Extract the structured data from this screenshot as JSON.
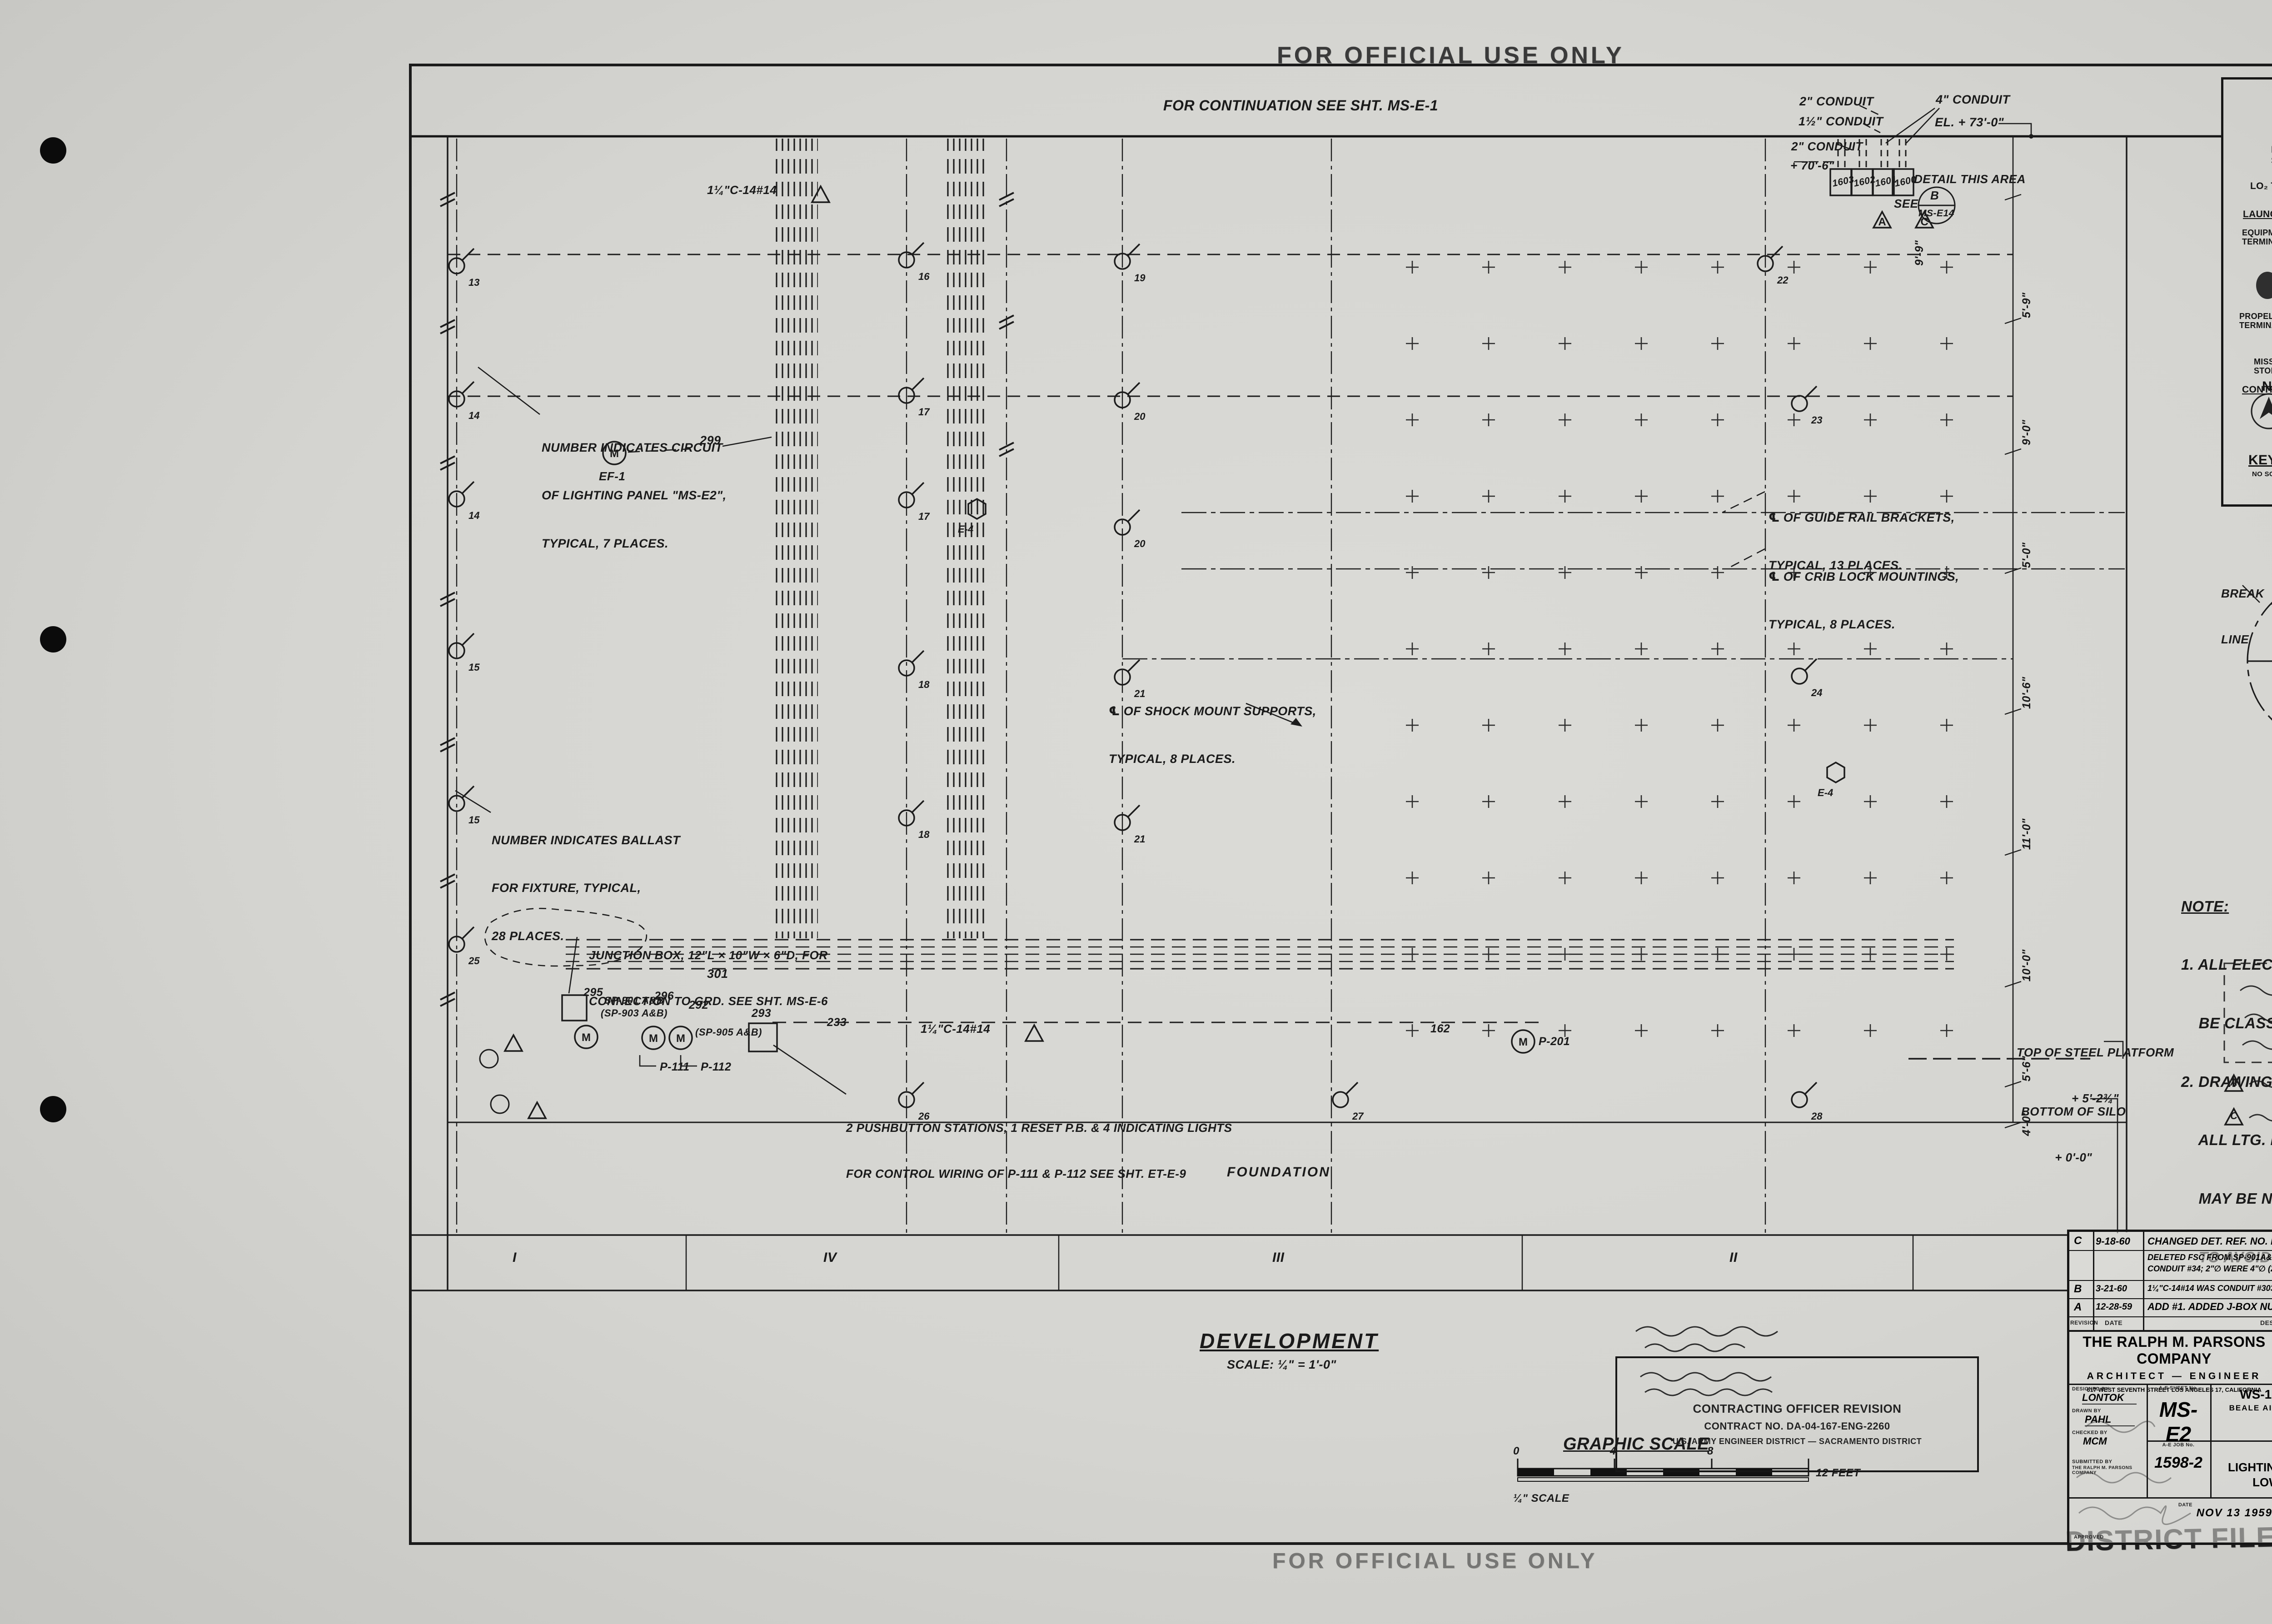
{
  "stamps": {
    "top": "FOR OFFICIAL USE ONLY",
    "bottom": "FOR OFFICIAL USE ONLY",
    "district_file": "DISTRICT FILE NO. 79-25-28"
  },
  "drawing": {
    "continuation": "FOR CONTINUATION SEE SHT. MS-E-1",
    "foundation": "FOUNDATION",
    "development_title": "DEVELOPMENT",
    "development_scale": "SCALE: ¼\" = 1'-0\"",
    "section_numerals": [
      "I",
      "IV",
      "III",
      "II"
    ],
    "notes": {
      "circuit": [
        "NUMBER INDICATES CIRCUIT",
        "OF LIGHTING PANEL \"MS-E2\",",
        "TYPICAL, 7 PLACES."
      ],
      "ballast": [
        "NUMBER INDICATES BALLAST",
        "FOR FIXTURE, TYPICAL,",
        "28 PLACES."
      ],
      "guide_rail": [
        "℄ OF GUIDE RAIL BRACKETS,",
        "TYPICAL, 13 PLACES."
      ],
      "crib_lock": [
        "℄ OF CRIB LOCK MOUNTINGS,",
        "TYPICAL, 8 PLACES."
      ],
      "shock_mount": [
        "℄ OF SHOCK MOUNT SUPPORTS,",
        "TYPICAL, 8 PLACES."
      ],
      "junction_box": [
        "JUNCTION BOX, 12\"L × 10\"W × 6\"D, FOR",
        "CONNECTION TO GRD. SEE SHT. MS-E-6"
      ],
      "pushbutton": [
        "2 PUSHBUTTON STATIONS, 1 RESET P.B. & 4 INDICATING LIGHTS",
        "FOR CONTROL WIRING OF P-111 & P-112 SEE SHT. ET-E-9"
      ]
    },
    "conduits": {
      "c2_top": "2\" CONDUIT",
      "c15": "1½\" CONDUIT",
      "c4": "4\" CONDUIT",
      "el73": "EL. + 73'-0\"",
      "c2_low": "2\" CONDUIT",
      "el70": "+ 70'-6\"",
      "size_note": "1¼\"C-14#14"
    },
    "pull_boxes": [
      "1603",
      "1602",
      "1601",
      "1600"
    ],
    "detail": {
      "l1": "DETAIL THIS AREA",
      "l2": "SEE",
      "flag_top": "B",
      "flag_bottom": "MS-E14"
    },
    "elevations": {
      "steel_1": "TOP OF STEEL PLATFORM",
      "steel_2": "+ 5'-2¾\"",
      "silo_1": "BOTTOM OF SILO",
      "silo_2": "+ 0'-0\""
    },
    "dims_right": [
      "5'-9\"",
      "9'-0\"",
      "5'-0\"",
      "10'-6\"",
      "11'-0\"",
      "10'-0\"",
      "5'-6\"",
      "4'-0\""
    ],
    "dim_top_right": "9'-9\"",
    "wire_tags": {
      "t299": "299",
      "t301": "301",
      "t295": "295",
      "t296": "296",
      "t292": "292",
      "t293": "293",
      "t162": "162",
      "t233": "233"
    },
    "equipment": {
      "ef1": "EF-1",
      "e4": "E-4",
      "p111": "P-111",
      "p112": "P-112",
      "p201": "P-201",
      "m": "M",
      "sp1": "SP-901 A&B",
      "sp2": "(SP-903 A&B)",
      "sp3": "(SP-905 A&B)"
    },
    "fixtures": [
      "13",
      "14",
      "14",
      "15",
      "15",
      "25",
      "16",
      "17",
      "17",
      "18",
      "18",
      "26",
      "19",
      "20",
      "20",
      "21",
      "21",
      "27",
      "22",
      "23",
      "24",
      "28"
    ],
    "tri_a": "A",
    "tri_b": "B",
    "tri_c": "C"
  },
  "key_plan": {
    "title": "KEY PLAN",
    "subtitle": "NO SCALE",
    "launcher1": "LAUNCHER No. 1",
    "launcher2": "LAUNCHER No. 2",
    "launcher3": "LAUNCHER No. 3",
    "missile_silo": "MISSILE SILO",
    "lo2_tank": "LO₂ TANK",
    "equipment_terminal": "EQUIPMENT TERMINAL",
    "propellant_terminal": "PROPELLANT TERMINAL",
    "missile_fuel_storage": "MISSILE FUEL STORAGE",
    "control_center": "CONTROL CENTER",
    "entry_portal": "ENTRY PORTAL",
    "powerhouse": "POWERHOUSE",
    "blast_lock_1": "BLAST LOCK No. 1",
    "blast_lock_2": "BLAST LOCK No. 2",
    "antenna_terminal": "ANTENNA TERMINAL",
    "west_antenna": "WEST ANTENNA SILO",
    "east_antenna": "EAST ANTENNA SILO",
    "north": "N",
    "tj": {
      "n1": "T.J. No. 1",
      "n2": "T.J. No. 2",
      "n4": "T.J. No. 4",
      "n5": "T.J. No. 5",
      "n7": "T.J. No. 7",
      "n8": "T.J. No. 8",
      "n9": "T.J. No. 9",
      "n10": "T.J. No. 10",
      "n11": "T.J. No. 11",
      "n12": "T.J. No. 12"
    }
  },
  "silo_keyplan": {
    "break_line": [
      "BREAK",
      "LINE"
    ],
    "q1": "I",
    "q2": "II",
    "q3": "III",
    "q4": "IV",
    "caption": "KEYPLAN FOR SILO"
  },
  "general_notes": {
    "heading": "NOTE:",
    "item1": [
      "1. ALL ELECTRICAL INSTALLATION SHALL",
      "    BE CLASS 1, DIVISION 2 PER N.E.C."
    ],
    "item2": [
      "2. DRAWINGS SHOW APPROX. LOCATION OF",
      "    ALL LTG. FIXTURES. SLIGHT DEVIATIONS",
      "    MAY BE NECESSARY DURING CONST.",
      "    TO AVOID DUCTS & PIPES."
    ]
  },
  "graphic_scale": {
    "label": "GRAPHIC SCALE",
    "t0": "0",
    "t4": "4",
    "t8": "8",
    "end": "12 FEET",
    "sub": "¼\" SCALE"
  },
  "contract_stamp": {
    "l1": "CONTRACTING OFFICER REVISION",
    "l2": "CONTRACT NO. DA-04-167-ENG-2260",
    "l3": "U.S. ARMY ENGINEER DISTRICT — SACRAMENTO DISTRICT"
  },
  "revisions": {
    "headers": {
      "rev": "REVISION",
      "date": "DATE",
      "desc": "DESCRIPTION",
      "agency": "AGENCY",
      "init": "INIT"
    },
    "rows": [
      {
        "sym": "C",
        "date": "9-18-60",
        "desc": "CHANGED DET. REF. NO. FOR PULL BOXES.",
        "agency": ""
      },
      {
        "sym": "",
        "date": "",
        "desc": "DELETED FSC FROM SP-901A&B, -903A&B, -905A&B & CONDUIT #34; 2\"∅ WERE 4\"∅ (2 PLACES)",
        "agency": "BMD/MA"
      },
      {
        "sym": "B",
        "date": "3-21-60",
        "desc": "1¼\"C-14#14 WAS CONDUIT #303. ADDED NOTE: \"1 RESET P.B.\"",
        "agency": "BMD/MA"
      },
      {
        "sym": "A",
        "date": "12-28-59",
        "desc": "ADD #1. ADDED J-BOX NUMBER & REV F.S.",
        "agency": "AFBMD"
      }
    ]
  },
  "title_block": {
    "firm": {
      "name": "THE RALPH M. PARSONS COMPANY",
      "role": "ARCHITECT — ENGINEER",
      "address": "617 WEST SEVENTH STREET   LOS ANGELES 17, CALIFORNIA"
    },
    "agency": {
      "name": "DEPARTMENT OF THE AIR FORCE",
      "division": "AIR FORCE BALLISTIC MISSILE DIVISION (ARDC)",
      "city": "LOS ANGELES 45, CALIFORNIA"
    },
    "fields": {
      "designed_label": "DESIGNED BY",
      "designed": "LONTOK",
      "drawn_label": "DRAWN BY",
      "drawn": "PAHL",
      "checked_label": "CHECKED BY",
      "checked": "MCM",
      "sheet_label": "A-E SHEET No.",
      "sheet": "MS-E2",
      "job_label": "A-E JOB No.",
      "job": "1598-2",
      "submitted_label": "SUBMITTED BY",
      "submitted": "THE RALPH M. PARSONS COMPANY",
      "date_label": "DATE",
      "date": "NOV 13 1959",
      "spec_label": "SPECIFICATION No.",
      "scale_label": "SCALE",
      "scale": "¼\" = 1'-0\"",
      "approved_label": "APPROVED",
      "sheet_number": "233"
    },
    "project": [
      "WS-107 A-2 TECHNICAL FACILITIES",
      "BEALE AIR FORCE BASE, MARYSVILLE, CALIFORNIA",
      "COMPLEX 1A, 1B & 1C"
    ],
    "title": [
      "MISSILE   SILO",
      "LIGHTING, POWER, LAUNCHER CONTROL",
      "LOWER SECTION DEVELOPMENT"
    ]
  }
}
